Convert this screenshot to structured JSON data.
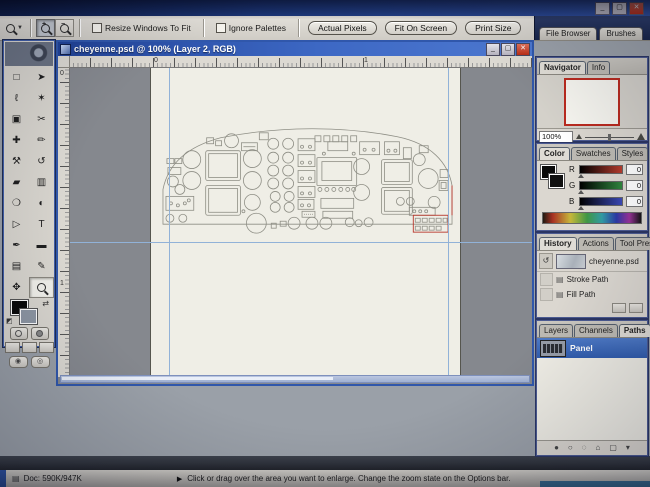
{
  "app": {
    "window_buttons": {
      "minimize": "_",
      "maximize": "▢",
      "close": "✕"
    }
  },
  "options_bar": {
    "zoom_in_sign": "+",
    "zoom_out_sign": "−",
    "checkbox_resize": "Resize Windows To Fit",
    "checkbox_ignore": "Ignore Palettes",
    "button_actual_pixels": "Actual Pixels",
    "button_fit_on_screen": "Fit On Screen",
    "button_print_size": "Print Size"
  },
  "palette_well": {
    "tabs": [
      {
        "label": "File Browser"
      },
      {
        "label": "Brushes"
      }
    ]
  },
  "doc_window": {
    "title": "cheyenne.psd @ 100% (Layer 2, RGB)",
    "buttons": {
      "minimize": "_",
      "maximize": "▢",
      "close": "✕"
    },
    "ruler_top_numbers": [
      "0",
      "1"
    ],
    "ruler_left_numbers": [
      "0",
      "1"
    ]
  },
  "toolbox": {
    "tools": [
      {
        "name": "rectangular-marquee",
        "glyph": "□"
      },
      {
        "name": "move",
        "glyph": "➤"
      },
      {
        "name": "lasso",
        "glyph": "ℓ"
      },
      {
        "name": "magic-wand",
        "glyph": "✶"
      },
      {
        "name": "crop",
        "glyph": "▣"
      },
      {
        "name": "slice",
        "glyph": "✂"
      },
      {
        "name": "healing-brush",
        "glyph": "✚"
      },
      {
        "name": "brush",
        "glyph": "✏"
      },
      {
        "name": "clone-stamp",
        "glyph": "⚒"
      },
      {
        "name": "history-brush",
        "glyph": "↺"
      },
      {
        "name": "eraser",
        "glyph": "▰"
      },
      {
        "name": "gradient",
        "glyph": "▥"
      },
      {
        "name": "blur",
        "glyph": "❍"
      },
      {
        "name": "dodge",
        "glyph": "◐"
      },
      {
        "name": "path-selection",
        "glyph": "▷"
      },
      {
        "name": "type",
        "glyph": "T"
      },
      {
        "name": "pen",
        "glyph": "✒"
      },
      {
        "name": "shape",
        "glyph": "▬"
      },
      {
        "name": "notes",
        "glyph": "▤"
      },
      {
        "name": "eyedropper",
        "glyph": "✎"
      },
      {
        "name": "hand",
        "glyph": "✥"
      }
    ]
  },
  "navigator": {
    "tabs": [
      {
        "label": "Navigator"
      },
      {
        "label": "Info"
      }
    ],
    "zoom_value": "100%"
  },
  "color": {
    "tabs": [
      {
        "label": "Color"
      },
      {
        "label": "Swatches"
      },
      {
        "label": "Styles"
      }
    ],
    "channels": [
      {
        "label": "R",
        "value": "0"
      },
      {
        "label": "G",
        "value": "0"
      },
      {
        "label": "B",
        "value": "0"
      }
    ]
  },
  "history": {
    "tabs": [
      {
        "label": "History"
      },
      {
        "label": "Actions"
      },
      {
        "label": "Tool Presets"
      }
    ],
    "snapshot_label": "cheyenne.psd",
    "items": [
      {
        "label": "Stroke Path"
      },
      {
        "label": "Fill Path"
      }
    ]
  },
  "paths": {
    "tabs": [
      {
        "label": "Layers"
      },
      {
        "label": "Channels"
      },
      {
        "label": "Paths"
      }
    ],
    "item_label": "Panel",
    "buttons": [
      {
        "name": "fill-path",
        "glyph": "●"
      },
      {
        "name": "stroke-path",
        "glyph": "○"
      },
      {
        "name": "load-selection",
        "glyph": "◌"
      },
      {
        "name": "make-work-path",
        "glyph": "⌂"
      },
      {
        "name": "new-path",
        "glyph": "▢"
      },
      {
        "name": "delete-path",
        "glyph": "▾"
      }
    ]
  },
  "status_bar": {
    "doc_size": "Doc: 590K/947K",
    "hint": "Click or drag over the area you want to enlarge. Change the zoom state on the Options bar."
  },
  "colors": {
    "guide_blue": "#8fb2dc",
    "navigator_view_red": "#c3271b",
    "selection_blue": "#2d5cb4",
    "titlebar_blue": "#1e43a0"
  }
}
